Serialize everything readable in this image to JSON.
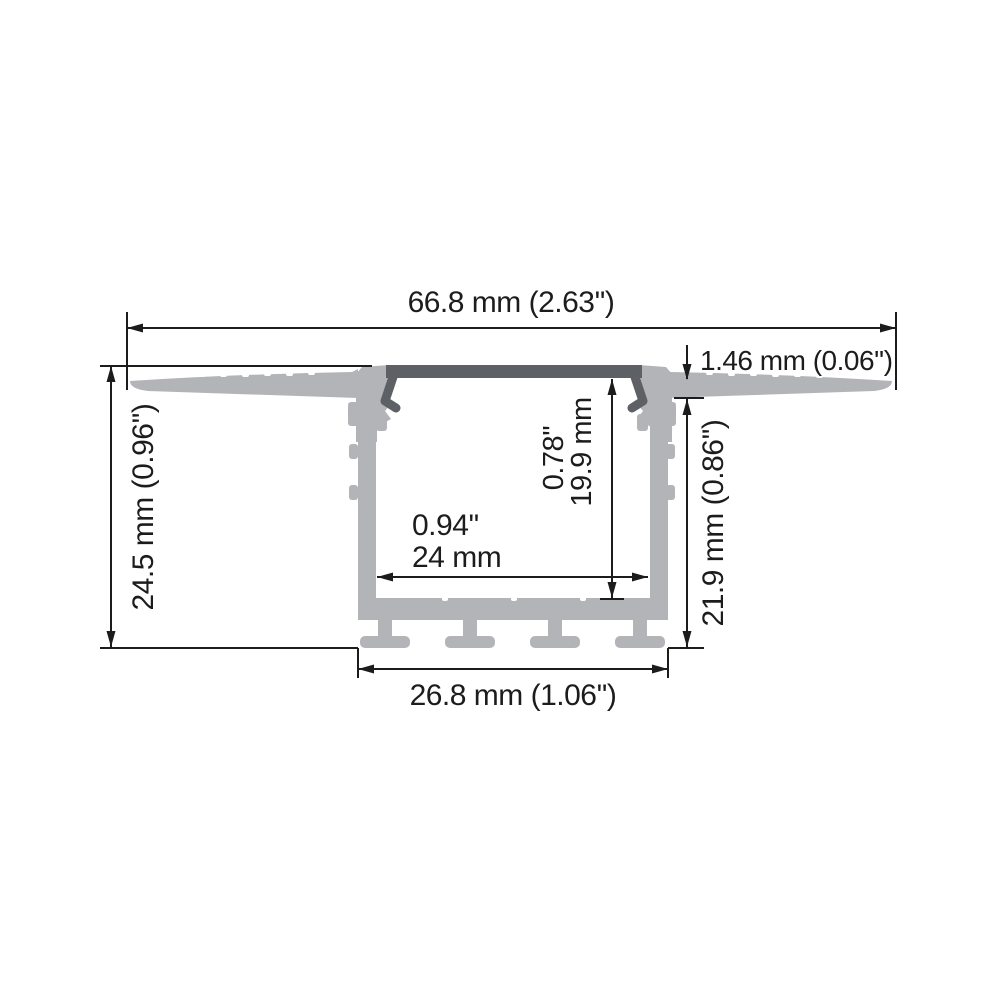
{
  "drawing": {
    "name": "recessed-led-aluminum-profile-cross-section",
    "colors": {
      "background": "#ffffff",
      "aluminum": "#b3b4b8",
      "cover": "#5d6064",
      "line": "#1c1c1c"
    },
    "dims": {
      "overall_width": "66.8 mm (2.63'')",
      "flange_thickness": "1.46 mm (0.06'')",
      "overall_height": "24.5 mm (0.96'')",
      "body_height": "21.9 mm (0.86'')",
      "inner_height_in": "0.78''",
      "inner_height_mm": "19.9 mm",
      "inner_width_in": "0.94''",
      "inner_width_mm": "24 mm",
      "base_width": "26.8 mm (1.06'')"
    }
  }
}
